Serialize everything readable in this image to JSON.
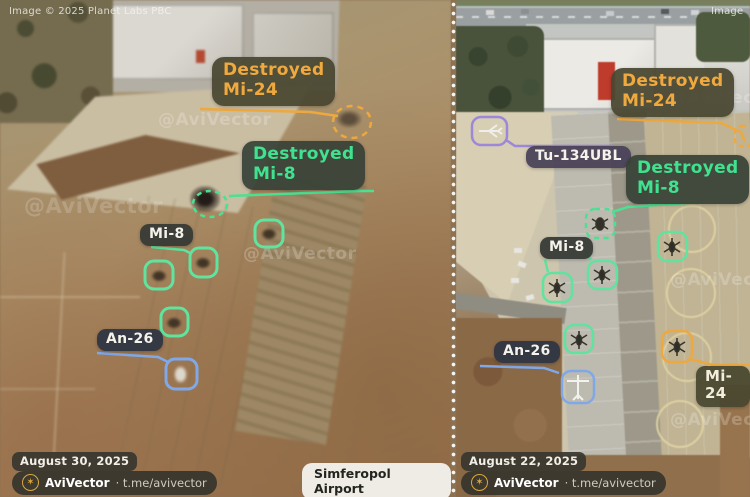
{
  "credits": {
    "planet": "Image © 2025 Planet Labs PBC",
    "planet_partial": "Image",
    "watermark": "@AviVector"
  },
  "location": {
    "airport": "Simferopol Airport",
    "region": "Crimea, Ukraine"
  },
  "icons": {
    "avivector_logo": "✶"
  },
  "colors": {
    "mi24_accent": "#EDA83F",
    "mi8_accent": "#4BE092",
    "an26_accent": "#7FA8E8",
    "tu134_accent": "#9D87D8",
    "brand_gold": "#D9A83E"
  },
  "left": {
    "date": "August 30, 2025",
    "brand": "AviVector",
    "handle": "· t.me/avivector",
    "labels": {
      "destroyed_mi24_l1": "Destroyed",
      "destroyed_mi24_l2": "Mi-24",
      "destroyed_mi8_l1": "Destroyed",
      "destroyed_mi8_l2": "Mi-8",
      "mi8": "Mi-8",
      "an26": "An-26"
    }
  },
  "right": {
    "date": "August 22, 2025",
    "brand": "AviVector",
    "handle": "· t.me/avivector",
    "labels": {
      "destroyed_mi24_l1": "Destroyed",
      "destroyed_mi24_l2": "Mi-24",
      "destroyed_mi8_l1": "Destroyed",
      "destroyed_mi8_l2": "Mi-8",
      "mi8": "Mi-8",
      "an26": "An-26",
      "tu134": "Tu-134UBL",
      "mi24": "Mi-24"
    }
  }
}
